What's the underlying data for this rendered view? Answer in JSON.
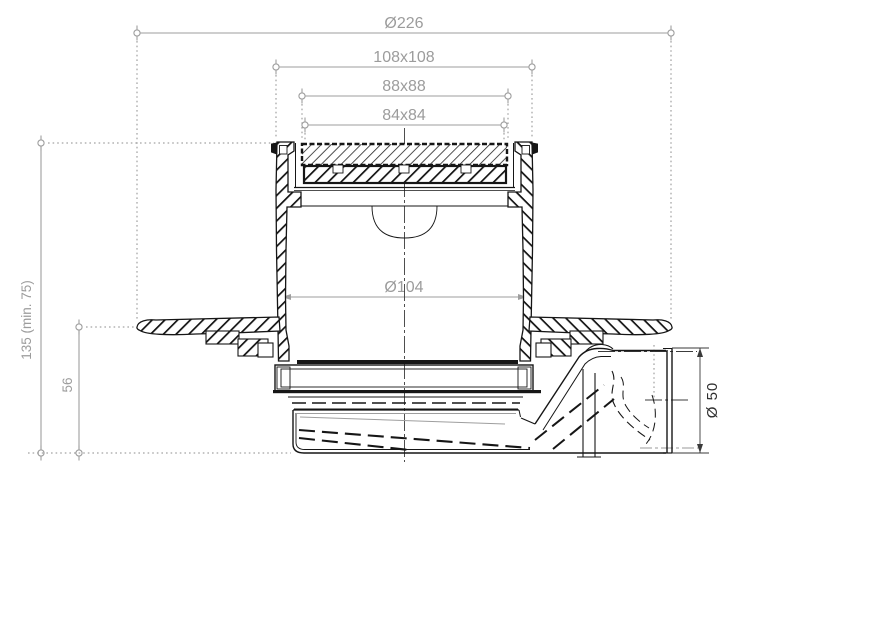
{
  "dimensions": {
    "overall_flange_width": "Ø226",
    "frame_outer": "108x108",
    "grate_outer": "88x88",
    "grate_inner": "84x84",
    "body_inner_diameter": "Ø104",
    "installation_height": "135 (min. 75)",
    "flange_to_bottom_height": "56",
    "outlet_diameter": "Ø 50"
  },
  "colors": {
    "dimension_gray": "#9e9e9e",
    "drawing_black": "#161616",
    "background": "#ffffff"
  }
}
